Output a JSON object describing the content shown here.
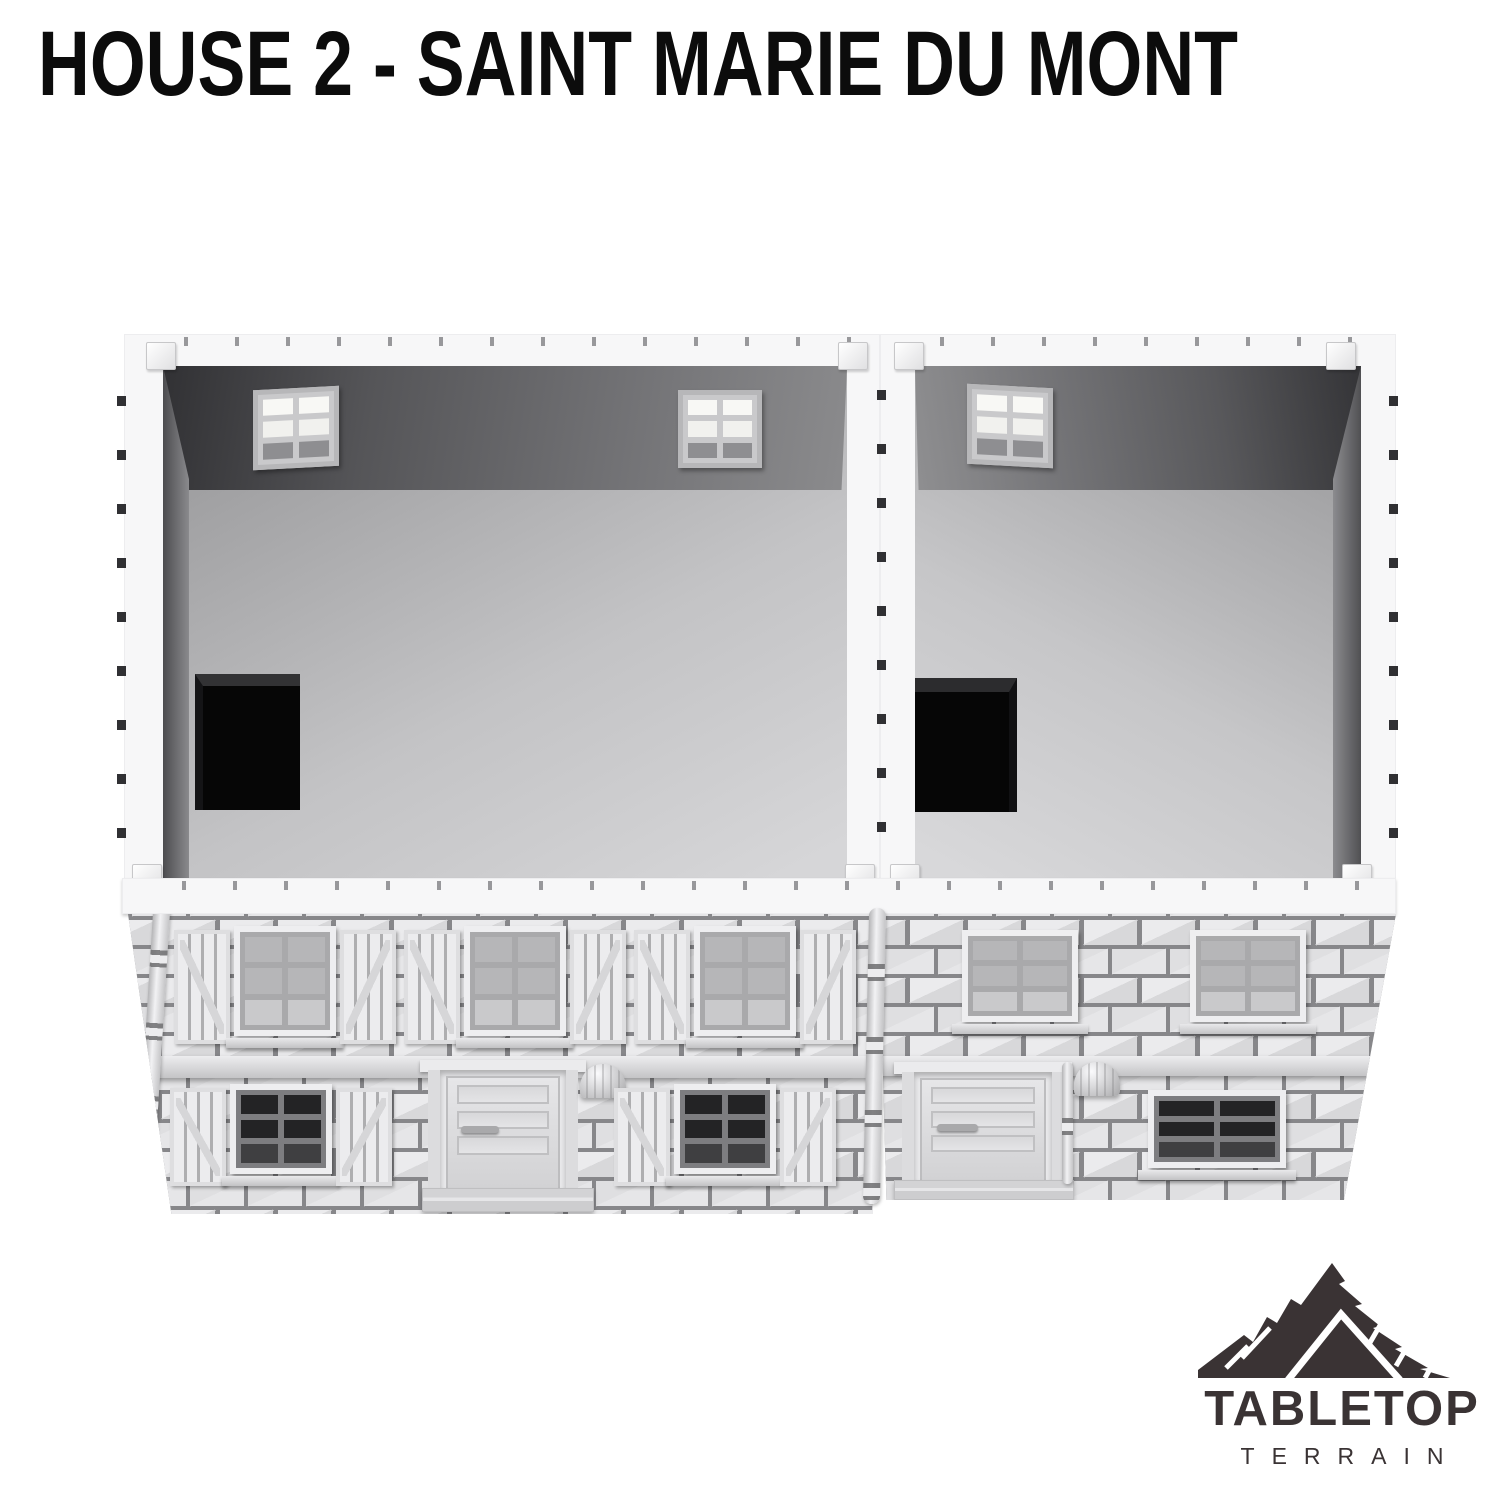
{
  "title": {
    "text": "HOUSE 2 - SAINT MARIE DU MONT",
    "color": "#0c0c0c"
  },
  "logo": {
    "name": "TABLETOP",
    "sub": "TERRAIN",
    "color": "#3a3334",
    "icon": "mountain-logo-icon"
  },
  "scene": {
    "subject": "3D render of a two-section stone house with removed roof showing empty upper-floor interiors",
    "left_unit": {
      "interior_windows": 2,
      "floor_hatches": 1,
      "upper_shuttered_windows": 3,
      "ground_shuttered_windows": 2,
      "doors": 1,
      "wall_lamps": 1
    },
    "right_unit": {
      "interior_windows": 1,
      "floor_hatches": 1,
      "upper_windows": 2,
      "ground_windows": 1,
      "doors": 1,
      "wall_lamps": 1
    },
    "colors": {
      "background": "#ffffff",
      "plastic_white": "#f7f7f8",
      "stone_mortar": "#87878a",
      "stone_light": "#e6e6e8",
      "interior_wall_dark": "#4a4a4d",
      "interior_floor_light": "#cfcfd1",
      "floor_hatch_black": "#060606"
    }
  }
}
